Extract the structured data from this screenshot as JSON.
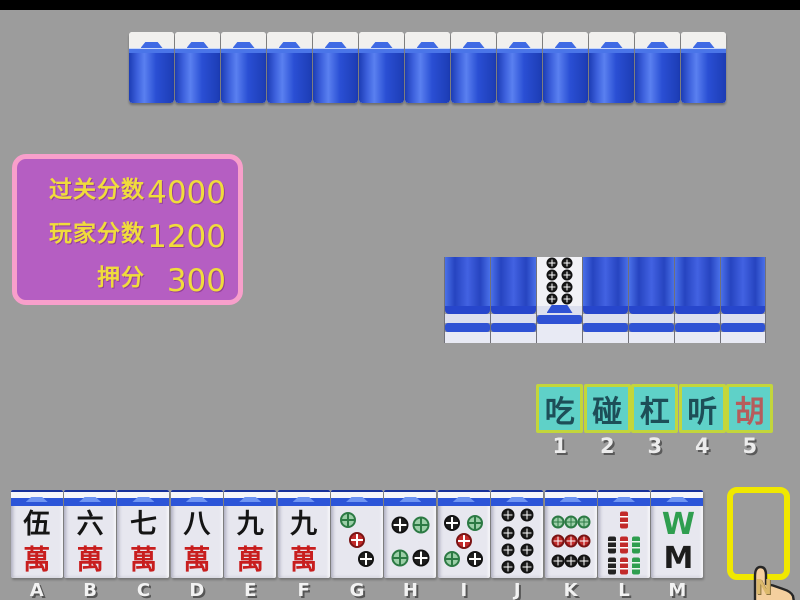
{
  "colors": {
    "background": "#9c9c9c",
    "panel_bg": "#b55ec2",
    "panel_border": "#f89fcb",
    "score_text": "#f0dc3c",
    "button_bg": "#5fd1c8",
    "button_border": "#c3d63b",
    "button_text": "#1d4e58",
    "button_text_hu": "#b65c5c",
    "tile_back_blue": "#2a4fd4",
    "slot_highlight": "#f0e800"
  },
  "score_panel": {
    "rows": [
      {
        "label": "过关分数",
        "value": "4000"
      },
      {
        "label": "玩家分数",
        "value": "1200"
      },
      {
        "label": "押分",
        "value": "300"
      }
    ]
  },
  "opponent_row": {
    "tile_count": 13
  },
  "meld_row": {
    "tiles": [
      {
        "type": "back"
      },
      {
        "type": "back"
      },
      {
        "type": "circle",
        "value": 8,
        "dot_size": 11,
        "dots": [
          {
            "x": 33,
            "y": 13,
            "color": "black"
          },
          {
            "x": 67,
            "y": 13,
            "color": "black"
          },
          {
            "x": 33,
            "y": 37,
            "color": "black"
          },
          {
            "x": 67,
            "y": 37,
            "color": "black"
          },
          {
            "x": 33,
            "y": 61,
            "color": "black"
          },
          {
            "x": 67,
            "y": 61,
            "color": "black"
          },
          {
            "x": 33,
            "y": 85,
            "color": "black"
          },
          {
            "x": 67,
            "y": 85,
            "color": "black"
          }
        ]
      },
      {
        "type": "back"
      },
      {
        "type": "back"
      },
      {
        "type": "back"
      },
      {
        "type": "back"
      }
    ]
  },
  "action_buttons": [
    {
      "name": "chi",
      "label": "吃",
      "key": "1",
      "accent": false
    },
    {
      "name": "peng",
      "label": "碰",
      "key": "2",
      "accent": false
    },
    {
      "name": "gang",
      "label": "杠",
      "key": "3",
      "accent": false
    },
    {
      "name": "ting",
      "label": "听",
      "key": "4",
      "accent": false
    },
    {
      "name": "hu",
      "label": "胡",
      "key": "5",
      "accent": true
    }
  ],
  "hand": {
    "tiles": [
      {
        "key": "A",
        "kind": "wan",
        "top_char": "伍",
        "bottom_char": "萬"
      },
      {
        "key": "B",
        "kind": "wan",
        "top_char": "六",
        "bottom_char": "萬"
      },
      {
        "key": "C",
        "kind": "wan",
        "top_char": "七",
        "bottom_char": "萬"
      },
      {
        "key": "D",
        "kind": "wan",
        "top_char": "八",
        "bottom_char": "萬"
      },
      {
        "key": "E",
        "kind": "wan",
        "top_char": "九",
        "bottom_char": "萬"
      },
      {
        "key": "F",
        "kind": "wan",
        "top_char": "九",
        "bottom_char": "萬"
      },
      {
        "key": "G",
        "kind": "circle",
        "value": 3,
        "dot_size": 16,
        "dots": [
          {
            "x": 32,
            "y": 20,
            "color": "green"
          },
          {
            "x": 50,
            "y": 47,
            "color": "red"
          },
          {
            "x": 68,
            "y": 74,
            "color": "black"
          }
        ]
      },
      {
        "key": "H",
        "kind": "circle",
        "value": 4,
        "dot_size": 17,
        "dots": [
          {
            "x": 30,
            "y": 26,
            "color": "black"
          },
          {
            "x": 70,
            "y": 26,
            "color": "green"
          },
          {
            "x": 30,
            "y": 72,
            "color": "green"
          },
          {
            "x": 70,
            "y": 72,
            "color": "black"
          }
        ]
      },
      {
        "key": "I",
        "kind": "circle",
        "value": 5,
        "dot_size": 16,
        "dots": [
          {
            "x": 28,
            "y": 24,
            "color": "black"
          },
          {
            "x": 72,
            "y": 24,
            "color": "green"
          },
          {
            "x": 50,
            "y": 48,
            "color": "red"
          },
          {
            "x": 28,
            "y": 74,
            "color": "green"
          },
          {
            "x": 72,
            "y": 74,
            "color": "black"
          }
        ]
      },
      {
        "key": "J",
        "kind": "circle",
        "value": 8,
        "dot_size": 13,
        "dots": [
          {
            "x": 32,
            "y": 13,
            "color": "black"
          },
          {
            "x": 68,
            "y": 13,
            "color": "black"
          },
          {
            "x": 32,
            "y": 37,
            "color": "black"
          },
          {
            "x": 68,
            "y": 37,
            "color": "black"
          },
          {
            "x": 32,
            "y": 61,
            "color": "black"
          },
          {
            "x": 68,
            "y": 61,
            "color": "black"
          },
          {
            "x": 32,
            "y": 85,
            "color": "black"
          },
          {
            "x": 68,
            "y": 85,
            "color": "black"
          }
        ]
      },
      {
        "key": "K",
        "kind": "circle",
        "value": 9,
        "dot_size": 13,
        "dots": [
          {
            "x": 25,
            "y": 22,
            "color": "green"
          },
          {
            "x": 50,
            "y": 22,
            "color": "green"
          },
          {
            "x": 75,
            "y": 22,
            "color": "green"
          },
          {
            "x": 25,
            "y": 49,
            "color": "red"
          },
          {
            "x": 50,
            "y": 49,
            "color": "red"
          },
          {
            "x": 75,
            "y": 49,
            "color": "red"
          },
          {
            "x": 25,
            "y": 76,
            "color": "black"
          },
          {
            "x": 50,
            "y": 76,
            "color": "black"
          },
          {
            "x": 75,
            "y": 76,
            "color": "black"
          }
        ]
      },
      {
        "key": "L",
        "kind": "bamboo",
        "value": 7,
        "sticks": [
          {
            "x": 50,
            "y": 20,
            "color": "red"
          },
          {
            "x": 26,
            "y": 54,
            "color": "black"
          },
          {
            "x": 50,
            "y": 54,
            "color": "red"
          },
          {
            "x": 74,
            "y": 54,
            "color": "green"
          },
          {
            "x": 26,
            "y": 84,
            "color": "black"
          },
          {
            "x": 50,
            "y": 84,
            "color": "red"
          },
          {
            "x": 74,
            "y": 84,
            "color": "green"
          }
        ]
      },
      {
        "key": "M",
        "kind": "bamboo8",
        "value": 8,
        "top_glyph": "W",
        "bottom_glyph": "M"
      }
    ],
    "draw_slot": {
      "key": "N"
    }
  }
}
